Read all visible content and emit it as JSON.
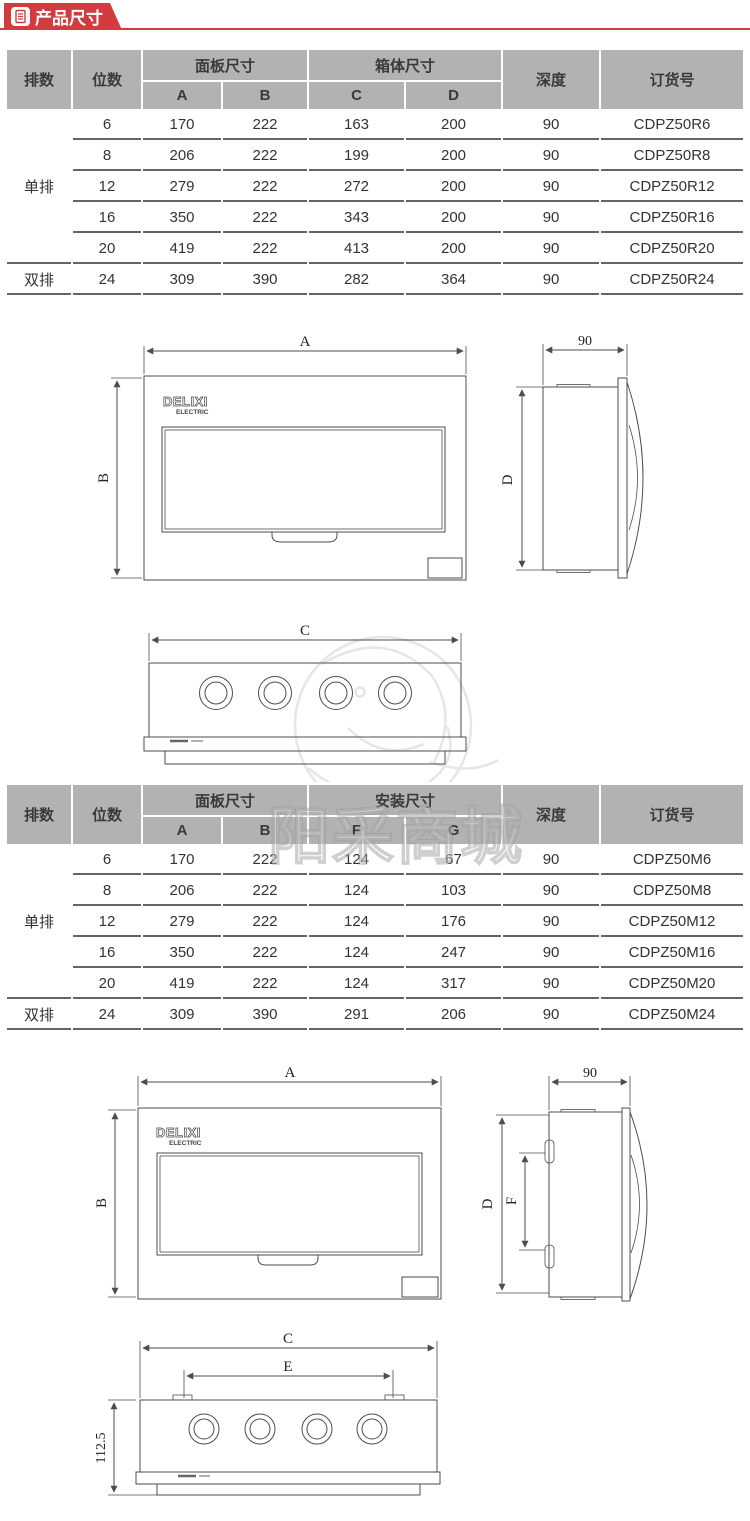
{
  "header": {
    "title": "产品尺寸",
    "accent_color": "#d23c40",
    "icon": "document-icon"
  },
  "watermark": {
    "text": "阳采商城"
  },
  "tables": [
    {
      "header": {
        "row": "排数",
        "pos": "位数",
        "panel_group": "面板尺寸",
        "panel_a": "A",
        "panel_b": "B",
        "box_group": "箱体尺寸",
        "box_c": "C",
        "box_d": "D",
        "depth": "深度",
        "order": "订货号"
      },
      "groups": [
        {
          "label": "单排",
          "span": 5
        },
        {
          "label": "双排",
          "span": 1
        }
      ],
      "rows": [
        [
          "6",
          "170",
          "222",
          "163",
          "200",
          "90",
          "CDPZ50R6"
        ],
        [
          "8",
          "206",
          "222",
          "199",
          "200",
          "90",
          "CDPZ50R8"
        ],
        [
          "12",
          "279",
          "222",
          "272",
          "200",
          "90",
          "CDPZ50R12"
        ],
        [
          "16",
          "350",
          "222",
          "343",
          "200",
          "90",
          "CDPZ50R16"
        ],
        [
          "20",
          "419",
          "222",
          "413",
          "200",
          "90",
          "CDPZ50R20"
        ],
        [
          "24",
          "309",
          "390",
          "282",
          "364",
          "90",
          "CDPZ50R24"
        ]
      ]
    },
    {
      "header": {
        "row": "排数",
        "pos": "位数",
        "panel_group": "面板尺寸",
        "panel_a": "A",
        "panel_b": "B",
        "install_group": "安装尺寸",
        "install_f": "F",
        "install_g": "G",
        "depth": "深度",
        "order": "订货号"
      },
      "groups": [
        {
          "label": "单排",
          "span": 5
        },
        {
          "label": "双排",
          "span": 1
        }
      ],
      "rows": [
        [
          "6",
          "170",
          "222",
          "124",
          "67",
          "90",
          "CDPZ50M6"
        ],
        [
          "8",
          "206",
          "222",
          "124",
          "103",
          "90",
          "CDPZ50M8"
        ],
        [
          "12",
          "279",
          "222",
          "124",
          "176",
          "90",
          "CDPZ50M12"
        ],
        [
          "16",
          "350",
          "222",
          "124",
          "247",
          "90",
          "CDPZ50M16"
        ],
        [
          "20",
          "419",
          "222",
          "124",
          "317",
          "90",
          "CDPZ50M20"
        ],
        [
          "24",
          "309",
          "390",
          "291",
          "206",
          "90",
          "CDPZ50M24"
        ]
      ]
    }
  ],
  "drawings": {
    "set1": {
      "front_width": "A",
      "front_height": "B",
      "side_depth": "90",
      "side_height": "D",
      "bottom_width": "C",
      "logo": "DELIXI",
      "logo_sub": "ELECTRIC"
    },
    "set2": {
      "front_width": "A",
      "front_height": "B",
      "side_depth": "90",
      "side_height": "D",
      "side_inner": "F",
      "bottom_width": "C",
      "bottom_inner": "E",
      "bottom_height": "112.5",
      "logo": "DELIXI",
      "logo_sub": "ELECTRIC"
    }
  }
}
